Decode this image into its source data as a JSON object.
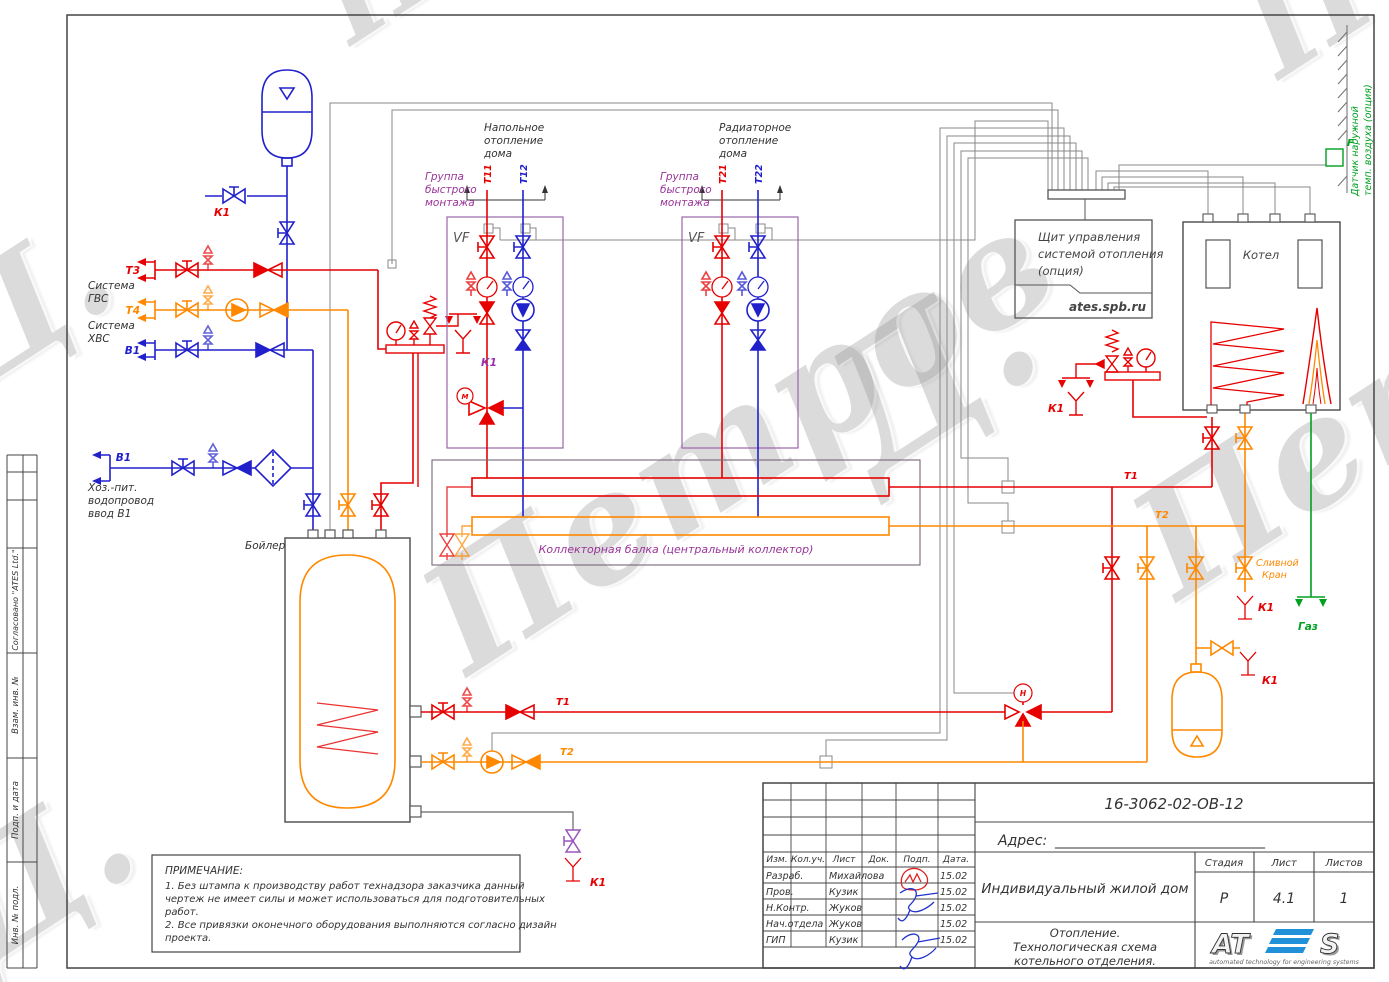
{
  "watermark": {
    "text": "Петров Д.",
    "name": "Петров",
    "initial": "Д."
  },
  "frame_strip": {
    "approved": "Согласовано \"ATES Ltd.\"",
    "vzam": "Взам. инв. №",
    "podp": "Подп. и дата",
    "inv": "Инв. № подл."
  },
  "labels": {
    "t3": "Т3",
    "t4": "Т4",
    "b1": "В1",
    "sys_gvs1": "Система",
    "sys_gvs2": "ГВС",
    "sys_hvs1": "Система",
    "sys_hvs2": "ХВС",
    "intro1": "Хоз.-пит.",
    "intro2": "водопровод",
    "intro3": "ввод В1",
    "k1": "К1",
    "boiler": "Бойлер",
    "floor1": "Напольное",
    "floor2": "отопление",
    "floor3": "дома",
    "rad1": "Радиаторное",
    "rad2": "отопление",
    "rad3": "дома",
    "grp1": "Группа",
    "grp2": "быстрого",
    "grp3": "монтажа",
    "vf": "VF",
    "t11": "Т11",
    "t12": "Т12",
    "t21": "Т21",
    "t22": "Т22",
    "collector": "Коллекторная балка (центральный коллектор)",
    "panel1": "Щит управления",
    "panel2": "системой отопления",
    "panel3": "(опция)",
    "panel_url": "ates.spb.ru",
    "kotel": "Котел",
    "f": "F",
    "sensor1": "Датчик наружной",
    "sensor2": "темп. воздуха (опция)",
    "t1": "Т1",
    "t2": "Т2",
    "drain1": "Сливной",
    "drain2": "Кран",
    "gas": "Газ",
    "motor_m": "М",
    "motor_n": "Н"
  },
  "notes": {
    "title": "ПРИМЕЧАНИЕ:",
    "l1": "1. Без штампа к производству работ технадзора заказчика данный",
    "l2": "чертеж не имеет силы и может использоваться для подготовительных",
    "l3": "работ.",
    "l4": "2. Все привязки оконечного оборудования выполняются согласно дизайн",
    "l5": "проекта."
  },
  "title_block": {
    "doc_number": "16-3062-02-ОВ-12",
    "address_label": "Адрес:",
    "address_line": "______________________________",
    "cols": [
      "Изм.",
      "Кол.уч.",
      "Лист",
      "Док.",
      "Подп.",
      "Дата."
    ],
    "rows": [
      {
        "role": "Разраб.",
        "name": "Михайлова",
        "date": "15.02"
      },
      {
        "role": "Пров.",
        "name": "Кузик",
        "date": "15.02"
      },
      {
        "role": "Н.Контр.",
        "name": "Жуков",
        "date": "15.02"
      },
      {
        "role": "Нач.отдела",
        "name": "Жуков",
        "date": "15.02"
      },
      {
        "role": "ГИП",
        "name": "Кузик",
        "date": "15.02"
      }
    ],
    "project": "Индивидуальный жилой дом",
    "stage_label": "Стадия",
    "sheet_label": "Лист",
    "sheets_label": "Листов",
    "stage": "Р",
    "sheet": "4.1",
    "sheets": "1",
    "subtitle1": "Отопление.",
    "subtitle2": "Технологическая схема",
    "subtitle3": "котельного отделения.",
    "logo_left": "AT",
    "logo_right": "S",
    "logo_tagline": "automated technology for engineering systems"
  },
  "colors": {
    "red": "#e60000",
    "orange": "#ff8800",
    "blue": "#2121cc",
    "purple": "#993399",
    "violet": "#9955bb",
    "green": "#00a020",
    "gray": "#555555",
    "wire": "#888888"
  }
}
